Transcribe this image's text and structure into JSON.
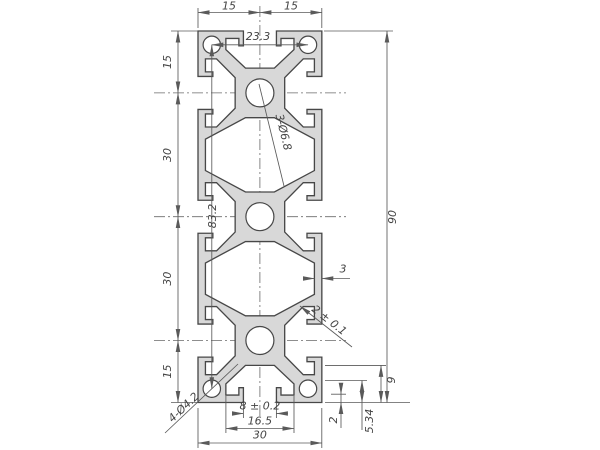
{
  "drawing": {
    "type": "technical-drawing-aluminium-extrusion-profile-30x90",
    "labels": {
      "top_width_left": "15",
      "top_width_right": "15",
      "corner_hole_pitch": "23.3",
      "left_seg1": "15",
      "left_seg2": "30",
      "left_seg3": "30",
      "left_seg4": "15",
      "corner_hole_span": "83.2",
      "overall_height": "90",
      "web_thickness": "3",
      "center_holes": "3-Ø6.8",
      "corner_holes": "4-Ø4.2",
      "lip_tolerance": "2 ± 0.1",
      "slot_opening": "8 ± 0.2",
      "slot_inner_width": "16.5",
      "overall_width": "30",
      "lip_depth": "2",
      "cavity_depth": "5.34",
      "slot_depth": "9"
    },
    "colors": {
      "profile_fill": "#d8d8d8",
      "line": "#5a5a5a",
      "text": "#444444"
    }
  }
}
